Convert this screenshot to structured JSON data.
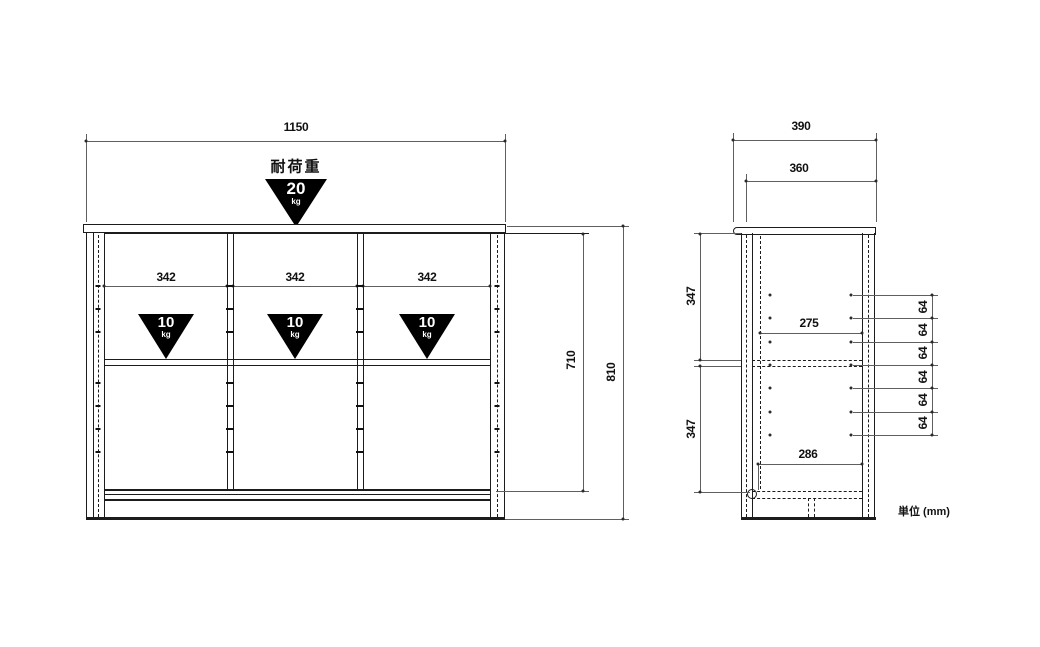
{
  "drawing": {
    "unit_note": "単位 (mm)",
    "load_heading": "耐荷重",
    "front": {
      "overall_width": "1150",
      "section_widths": [
        "342",
        "342",
        "342"
      ],
      "interior_height": "710",
      "overall_height": "810",
      "top_load": {
        "value": "20",
        "unit": "kg"
      },
      "shelf_loads": [
        {
          "value": "10",
          "unit": "kg"
        },
        {
          "value": "10",
          "unit": "kg"
        },
        {
          "value": "10",
          "unit": "kg"
        }
      ]
    },
    "side": {
      "overall_depth": "390",
      "top_depth": "360",
      "upper_interior_height": "347",
      "lower_interior_height": "347",
      "upper_interior_depth": "275",
      "lower_interior_depth": "286",
      "pin_pitches": [
        "64",
        "64",
        "64",
        "64",
        "64",
        "64"
      ]
    },
    "colors": {
      "structure_line": "#1c1c1c",
      "dimension_line": "#5f5f5f",
      "triangle_fill": "#000000",
      "triangle_text": "#ffffff",
      "background": "#ffffff"
    }
  }
}
